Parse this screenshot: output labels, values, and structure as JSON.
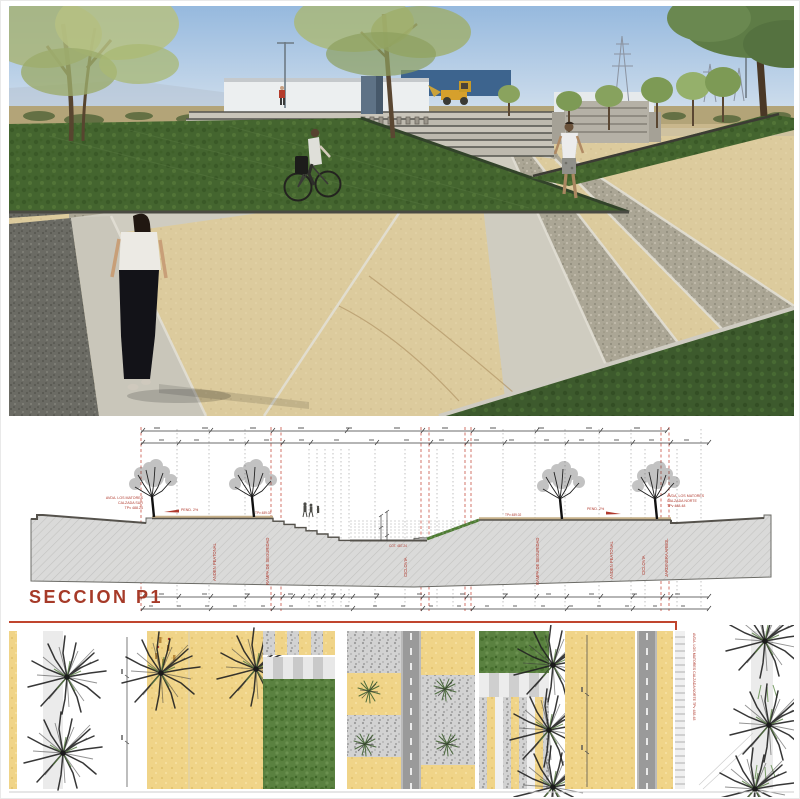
{
  "section": {
    "title": "SECCION  P1",
    "road_label_left": {
      "l1": "AVDA. LOS MATORES",
      "l2": "CALZADA SUR",
      "l3": "TPv 488.24"
    },
    "road_label_right": {
      "l1": "AVDA. LOS MATORES",
      "l2": "CALZADA NORTE",
      "l3": "TPv 488.48"
    },
    "slope_label_left": "PEND. 2%",
    "slope_label_right": "PEND. 2%",
    "level_label_steps": "TPv 489.02",
    "level_label_slope": "TPv 489.02",
    "level_label_center": "COT. 487.24",
    "vertical_labels": [
      "ANDEN PEATONAL",
      "RAMPA DE SEGURIDAD",
      "CICLOVIA",
      "RAMPA DE SEGURIDAD",
      "ANDEN PEATONAL",
      "CICLOVIA",
      "JARDINERA ARBOL"
    ]
  },
  "plan": {
    "road_label_vertical": "AVDA. LOS MATORES   CALZADA NORTE   TPv 488.48"
  },
  "colors": {
    "annotation_red": "#b03a2e",
    "divider_red": "#c0452e",
    "sand": "#f0d488",
    "grass": "#55803a",
    "gravel": "#c9c9c9",
    "road_gray": "#9a9a9a"
  }
}
